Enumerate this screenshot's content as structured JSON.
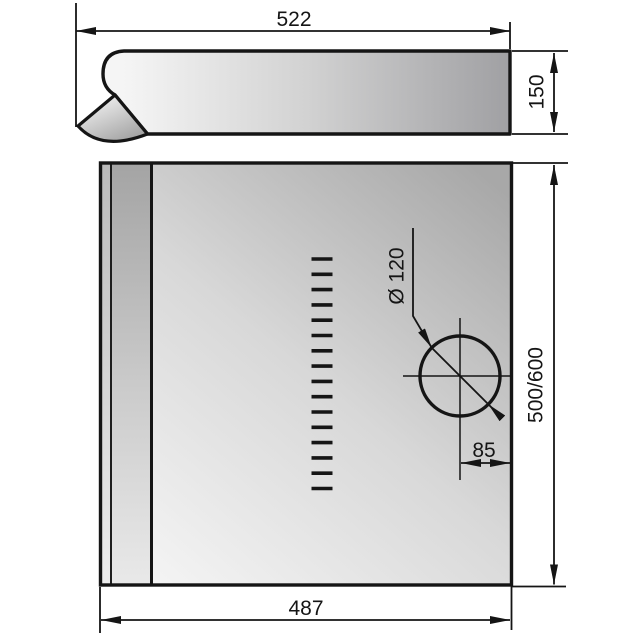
{
  "page": {
    "background": "#ffffff",
    "line_color": "#151515"
  },
  "drawing": {
    "side_view": {
      "width": "522",
      "height": "150"
    },
    "front_view": {
      "width": "487",
      "height": "500/600",
      "duct_hole": {
        "diameter": "Ø 120",
        "edge_offset": "85"
      },
      "vent_slot_count": 16
    }
  }
}
